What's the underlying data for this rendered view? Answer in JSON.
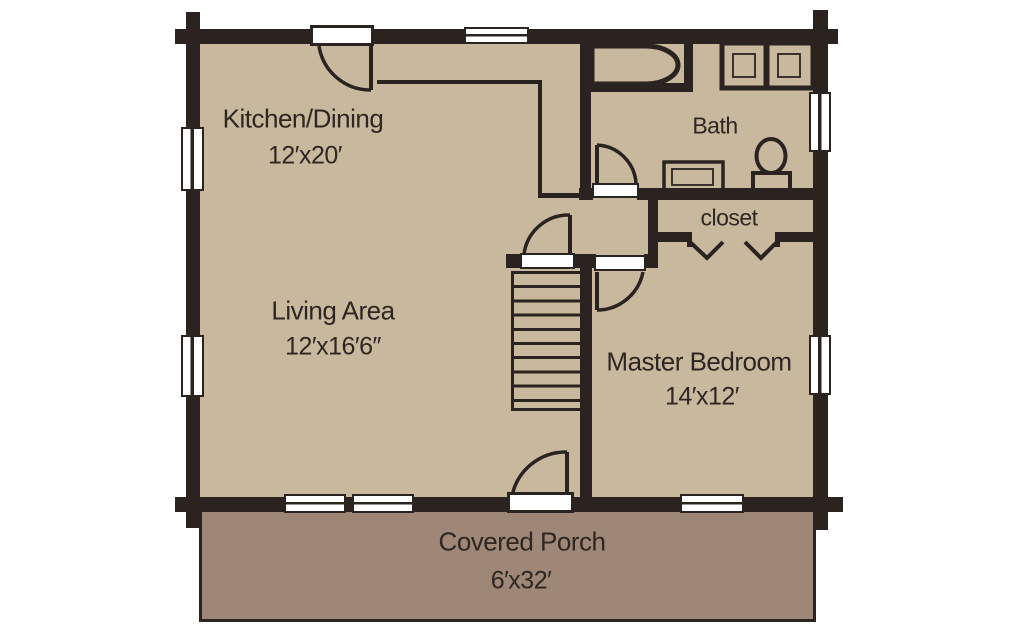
{
  "plan": {
    "rooms": [
      {
        "id": "kitchen-dining",
        "name": "Kitchen/Dining",
        "dims": "12′x20′"
      },
      {
        "id": "living-area",
        "name": "Living Area",
        "dims": "12′x16′6″"
      },
      {
        "id": "master-bedroom",
        "name": "Master Bedroom",
        "dims": "14′x12′"
      },
      {
        "id": "bath",
        "name": "Bath",
        "dims": ""
      },
      {
        "id": "closet",
        "name": "closet",
        "dims": ""
      },
      {
        "id": "covered-porch",
        "name": "Covered Porch",
        "dims": "6′x32′"
      }
    ],
    "fixtures": [
      "bathtub",
      "toilet",
      "vanity-sink",
      "cabinet",
      "cabinet",
      "staircase",
      "closet-bifold-doors",
      "kitchen-counter"
    ],
    "colors": {
      "floor": "#c8b99e",
      "porch": "#9e8777",
      "wall": "#2a231f",
      "text": "#2e2620",
      "background": "#ffffff"
    }
  }
}
